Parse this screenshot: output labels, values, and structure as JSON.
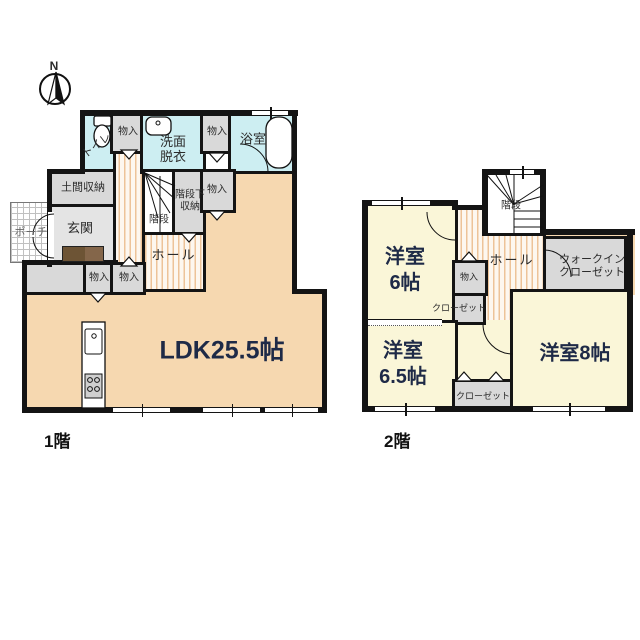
{
  "title": "2-story house floor plan",
  "compass": {
    "north_label": "N"
  },
  "palette": {
    "wall": "#141414",
    "ldk_fill": "#f6d8b0",
    "bedroom_fill": "#faf6d8",
    "wet_area_fill": "#cdeef2",
    "closet_fill": "#d9d9d9",
    "entrance_fill": "#e4e4e4",
    "flooring_stripe": "#edc398",
    "room_size_text": "#1e2a47"
  },
  "floor1": {
    "name_label": "1階",
    "ldk": "LDK25.5帖",
    "toilet": "トイレ",
    "storage": "物入",
    "washroom_line1": "洗面",
    "washroom_line2": "脱衣",
    "bath": "浴室",
    "doma_storage": "土間収納",
    "entrance": "玄関",
    "porch": "ポーチ",
    "stairs": "階段",
    "understairs_line1": "階段下",
    "understairs_line2": "収納",
    "hall": "ホール"
  },
  "floor2": {
    "name_label": "2階",
    "stairs": "階段",
    "room6_line1": "洋室",
    "room6_line2": "6帖",
    "hall": "ホール",
    "storage": "物入",
    "wic_line1": "ウォークイン",
    "wic_line2": "クローゼット",
    "closet": "クローゼット",
    "room65_line1": "洋室",
    "room65_line2": "6.5帖",
    "room8": "洋室8帖"
  }
}
